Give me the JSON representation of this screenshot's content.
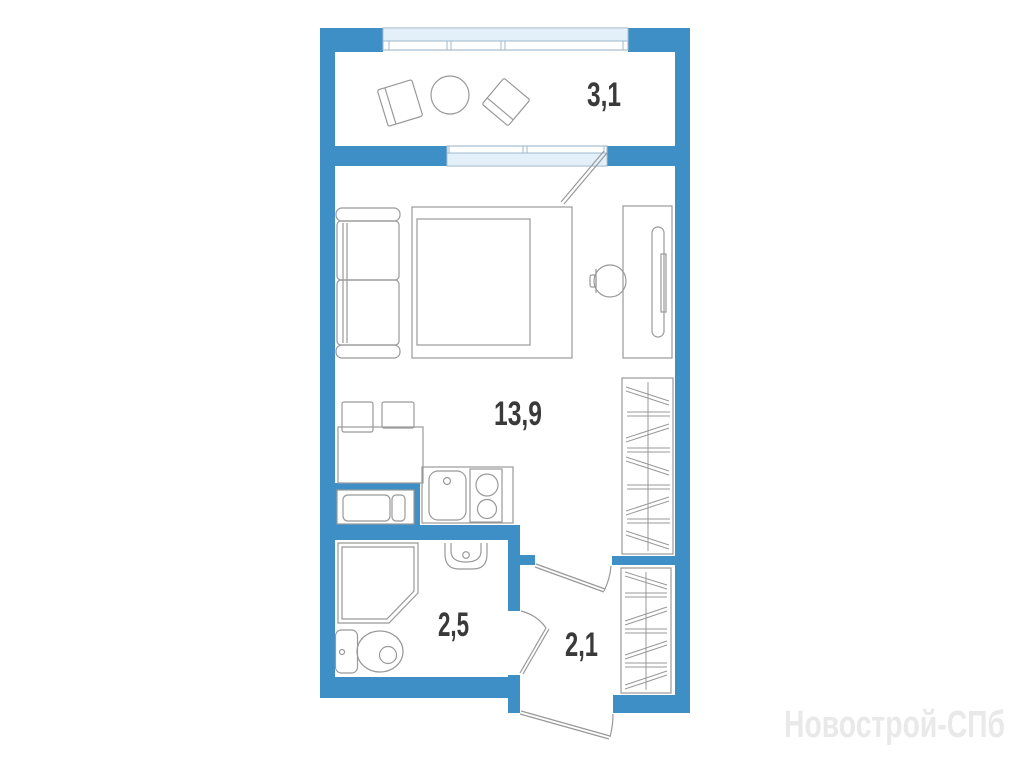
{
  "plan": {
    "watermark": "Новострой-СПб",
    "rooms": [
      {
        "name": "balcony",
        "area": "3,1"
      },
      {
        "name": "living-room",
        "area": "13,9"
      },
      {
        "name": "bathroom",
        "area": "2,5"
      },
      {
        "name": "hallway",
        "area": "2,1"
      }
    ],
    "colors": {
      "wall": "#3E8FC6",
      "glazing": "#E3F0F9",
      "line": "#999999",
      "label": "#3A3A3A",
      "watermark": "#E9E9E9"
    },
    "symbols": [
      "balcony-chair",
      "balcony-round-table",
      "sofa",
      "double-bed",
      "desk",
      "desk-chair",
      "wardrobe",
      "kitchen-table",
      "kitchen-chair",
      "washing-machine",
      "kitchen-sink",
      "stove-two-burner",
      "shower-cabin",
      "washbasin",
      "toilet",
      "door-swing",
      "window"
    ]
  }
}
